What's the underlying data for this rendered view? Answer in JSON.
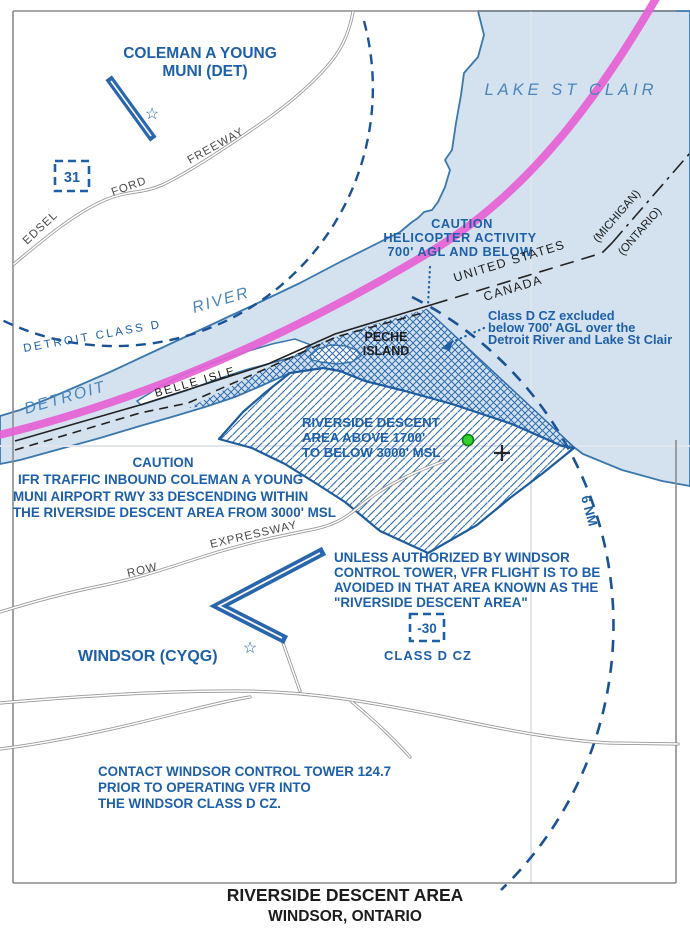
{
  "colors": {
    "water": "#d4e2f0",
    "shore": "#3a77ad",
    "note_blue": "#1d5fa8",
    "hatch_blue": "#2f6cae",
    "river_label_blue": "#4a86bd",
    "magenta": "#e661d5",
    "road_gray": "#979797",
    "green_dot": "#2fd02f",
    "black": "#1c1c1c"
  },
  "airports": {
    "detroit": {
      "name_line1": "COLEMAN A YOUNG",
      "name_line2": "MUNI (DET)",
      "box_label": "31"
    },
    "windsor": {
      "name": "WINDSOR (CYQG)",
      "box_label": "-30",
      "box_sublabel": "CLASS D CZ"
    }
  },
  "water_labels": {
    "lake": "LAKE ST CLAIR",
    "river_word1": "DETROIT",
    "river_word2": "RIVER"
  },
  "islands": {
    "belle": "BELLE ISLE",
    "peche_line1": "PECHE",
    "peche_line2": "ISLAND"
  },
  "boundary": {
    "us": "UNITED STATES",
    "canada": "CANADA",
    "michigan": "(MICHIGAN)",
    "ontario": "(ONTARIO)"
  },
  "airspace": {
    "detroit_class_d": "DETROIT CLASS D",
    "six_nm": "6 NM",
    "descent_area": [
      "RIVERSIDE DESCENT",
      "AREA ABOVE 1700'",
      "TO BELOW 3000' MSL"
    ]
  },
  "notes": {
    "helicopter": [
      "CAUTION",
      "HELICOPTER ACTIVITY",
      "700' AGL AND BELOW"
    ],
    "excluded": [
      "Class D CZ excluded",
      "below 700' AGL over the",
      "Detroit River and Lake St Clair"
    ],
    "ifr": [
      "CAUTION",
      "IFR TRAFFIC INBOUND COLEMAN A YOUNG",
      "MUNI AIRPORT RWY 33 DESCENDING WITHIN",
      "THE RIVERSIDE DESCENT AREA FROM 3000' MSL"
    ],
    "unless": [
      "UNLESS AUTHORIZED BY WINDSOR",
      "CONTROL TOWER, VFR FLIGHT IS TO BE",
      "AVOIDED IN THAT AREA KNOWN AS THE",
      "\"RIVERSIDE DESCENT AREA\""
    ],
    "contact": [
      "CONTACT WINDSOR CONTROL TOWER 124.7",
      "PRIOR TO OPERATING VFR INTO",
      "THE WINDSOR CLASS D CZ."
    ]
  },
  "roads": {
    "edsel": "EDSEL",
    "ford": "FORD",
    "freeway": "FREEWAY",
    "row": "ROW",
    "expressway": "EXPRESSWAY"
  },
  "title": {
    "line1": "RIVERSIDE DESCENT AREA",
    "line2": "WINDSOR, ONTARIO"
  }
}
